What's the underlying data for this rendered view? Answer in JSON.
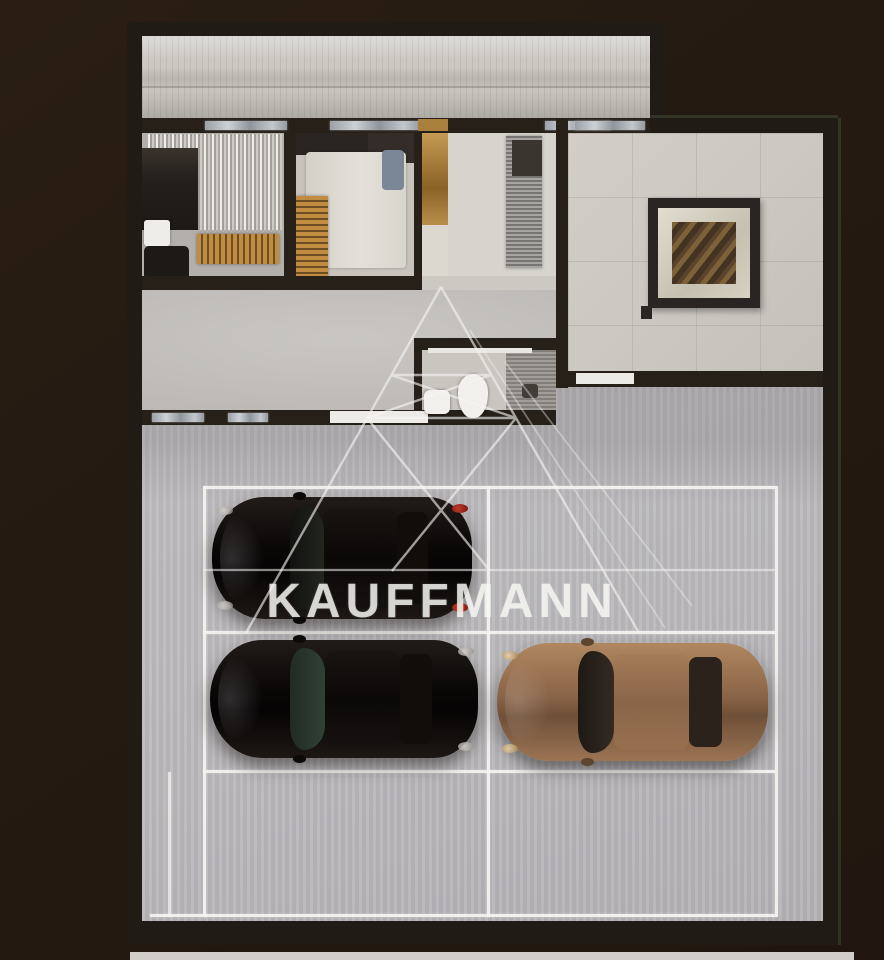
{
  "image": {
    "kind": "apartment floor plan 3D render with private parking, top-down view",
    "width_px": 884,
    "height_px": 960,
    "background_color": "#241a11"
  },
  "watermark": {
    "text": "KAUFFMANN",
    "logo": "wireframe-pyramid",
    "color": "#f6f5f2"
  },
  "floor_plan": {
    "rooms": [
      {
        "name": "terrace-strip",
        "position": "top",
        "floor_color": "#c6c3bd"
      },
      {
        "name": "bedroom-1",
        "position": "top-left",
        "furniture": [
          "bed",
          "curtains",
          "armchair",
          "gold-slat-dresser",
          "white-side-table"
        ]
      },
      {
        "name": "bedroom-2",
        "position": "top-center-left",
        "furniture": [
          "white-bed",
          "blue-pillows",
          "gold-slat-wardrobe",
          "wall-tv"
        ]
      },
      {
        "name": "closet-column",
        "position": "center",
        "furniture": [
          "tan-cabinet"
        ]
      },
      {
        "name": "kitchen",
        "position": "top-center",
        "furniture": [
          "stone-counter",
          "dark-appliance"
        ]
      },
      {
        "name": "hallway",
        "position": "center"
      },
      {
        "name": "bathroom",
        "position": "center-bottom",
        "furniture": [
          "toilet",
          "sink",
          "shower"
        ]
      },
      {
        "name": "lounge-room",
        "position": "left-bottom-of-plan",
        "furniture": []
      },
      {
        "name": "living-room",
        "position": "right",
        "furniture": [
          "framed-square-table-art"
        ]
      }
    ],
    "wall_color": "#262019",
    "window_glass_color": "#c3c8cc"
  },
  "parking": {
    "rows": 3,
    "columns": 2,
    "marked_spaces": 6,
    "line_color": "#f2f1ed",
    "floor_color": "#bcbabc",
    "cars": [
      {
        "spot": "row-1-left",
        "color_name": "black",
        "body_hex": "#0d0a08",
        "facing": "left",
        "taillights": "red"
      },
      {
        "spot": "row-2-left",
        "color_name": "black",
        "body_hex": "#0d0a08",
        "facing": "left",
        "windshield_tint": "green"
      },
      {
        "spot": "row-2-right",
        "color_name": "bronze",
        "body_hex": "#8f6b4e",
        "facing": "left"
      }
    ],
    "empty_spots": [
      "row-1-right",
      "row-3-left",
      "row-3-right"
    ]
  },
  "footer": {
    "bottom_strip_color": "#d1cec9"
  }
}
